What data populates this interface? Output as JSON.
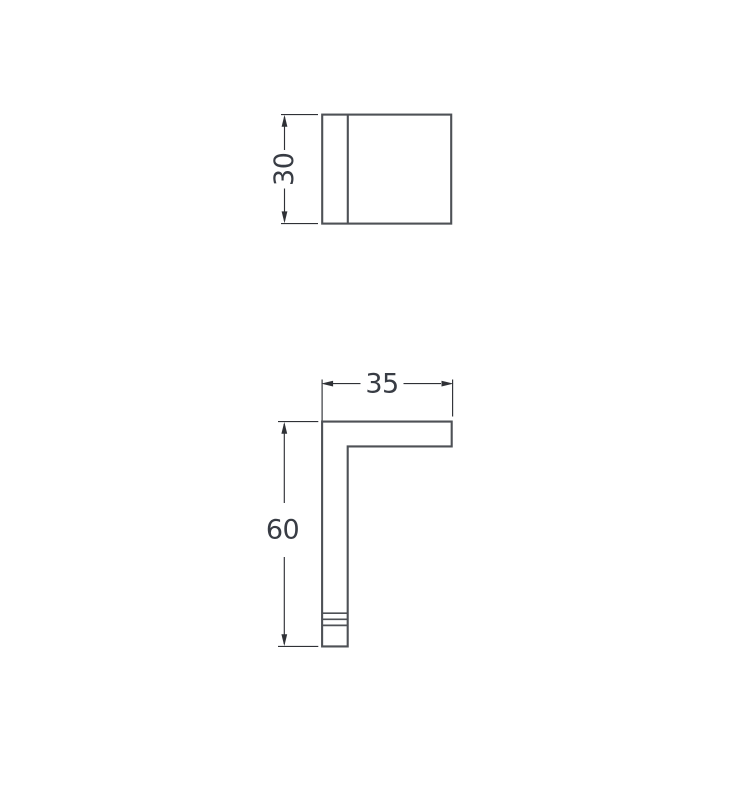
{
  "colors": {
    "background": "#ffffff",
    "part_outline": "#4e5156",
    "dimension_line": "#2f3136",
    "label_text": "#383c44"
  },
  "drawing": {
    "kind": "technical-dimension-drawing",
    "views": [
      {
        "name": "front-view",
        "dimensions": [
          {
            "label": "30",
            "axis": "vertical",
            "side": "left"
          }
        ]
      },
      {
        "name": "side-view",
        "dimensions": [
          {
            "label": "35",
            "axis": "horizontal",
            "side": "top"
          },
          {
            "label": "60",
            "axis": "vertical",
            "side": "left"
          }
        ]
      }
    ]
  }
}
